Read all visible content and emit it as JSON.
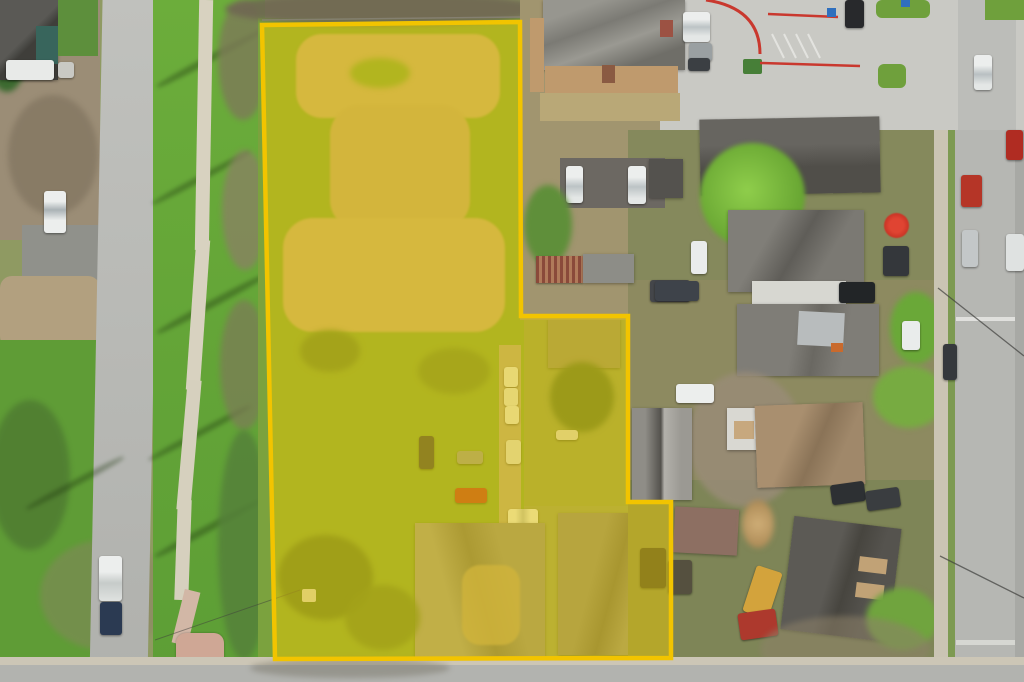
{
  "scene": {
    "description": "Aerial drone photograph of a residential neighborhood with a large vacant corner lot highlighted by a yellow property-boundary overlay",
    "highlighted_lot": {
      "shape": "irregular stepped polygon",
      "points": "262,25 520,22 521,316 628,316 628,502 671,502 671,658 275,659",
      "stroke": "#f2c400",
      "stroke_width": "4.5",
      "fill": "#eac800",
      "fill_opacity": "0.5"
    },
    "palette": {
      "grass_bright": "#6cad3b",
      "grass_dark": "#55813a",
      "dirt": "#c2a87c",
      "scrub": "#a1956f",
      "road": "#b5b6b2",
      "concrete_lot": "#c9c9c4",
      "sidewalk": "#d8d2c0",
      "plaza_pad": "#cfa795",
      "roof_charcoal": "#55534e",
      "roof_gray": "#8d8c88",
      "roof_brown": "#a0886a",
      "brick": "#bf9a6d",
      "red_curb": "#c9382e",
      "handicap_blue": "#2f6fbe",
      "car_white": "#eceeed",
      "car_red": "#b53527",
      "car_dark": "#2d3033",
      "tree_green": "#5f8f3a",
      "tree_bright": "#7fc043",
      "umbrella_red": "#d84330"
    }
  }
}
